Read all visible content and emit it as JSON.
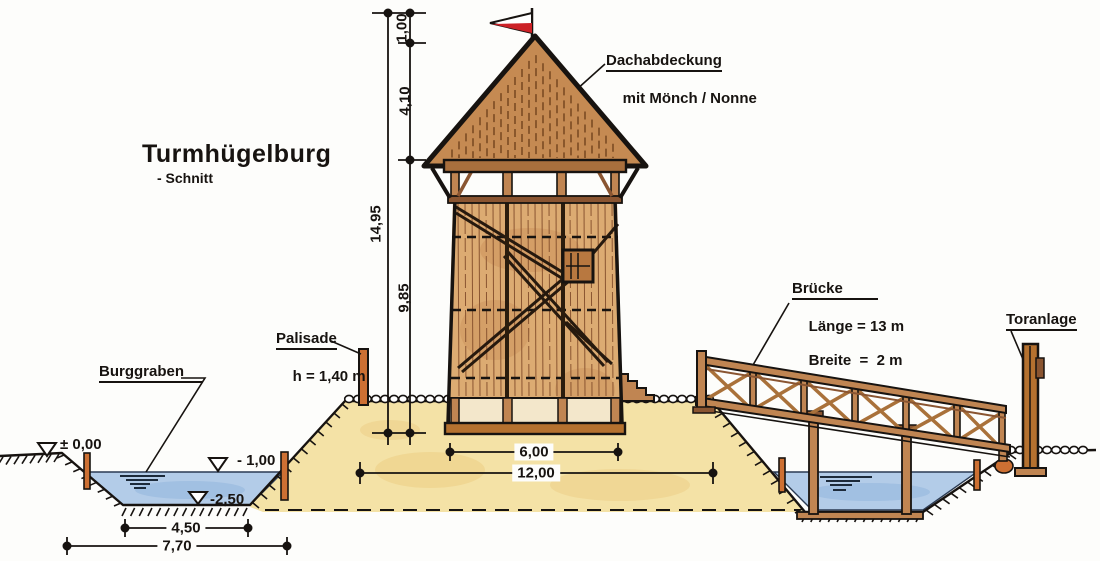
{
  "drawing": {
    "title": "Turmhügelburg",
    "subtitle": "- Schnitt"
  },
  "annotations": {
    "roof_label_line1": "Dachabdeckung",
    "roof_label_line2": "mit Mönch / Nonne",
    "bridge_name": "Brücke",
    "bridge_length": "Länge = 13 m",
    "bridge_width": "Breite  =  2 m",
    "gate_label": "Toranlage",
    "palisade_name": "Palisade",
    "palisade_height": "h = 1,40 m",
    "moat_label": "Burggraben"
  },
  "dimensions": {
    "flag_mast": "1,00",
    "roof_height": "4,10",
    "total_height": "14,95",
    "wall_height": "9,85",
    "tower_base_width": "6,00",
    "mound_top_width": "12,00",
    "moat_bottom_width": "4,50",
    "moat_top_width": "7,70"
  },
  "levels": {
    "ground_level": "± 0,00",
    "water_level": "- 1,00",
    "moat_depth": "-2,50"
  },
  "colors": {
    "ink": "#171310",
    "wood": "#c08552",
    "wood_dark": "#8a5531",
    "post_orange": "#cd7033",
    "mound_sand": "#f4e2a6",
    "water_blue": "#b3cce8",
    "flag_red": "#cc2127"
  }
}
